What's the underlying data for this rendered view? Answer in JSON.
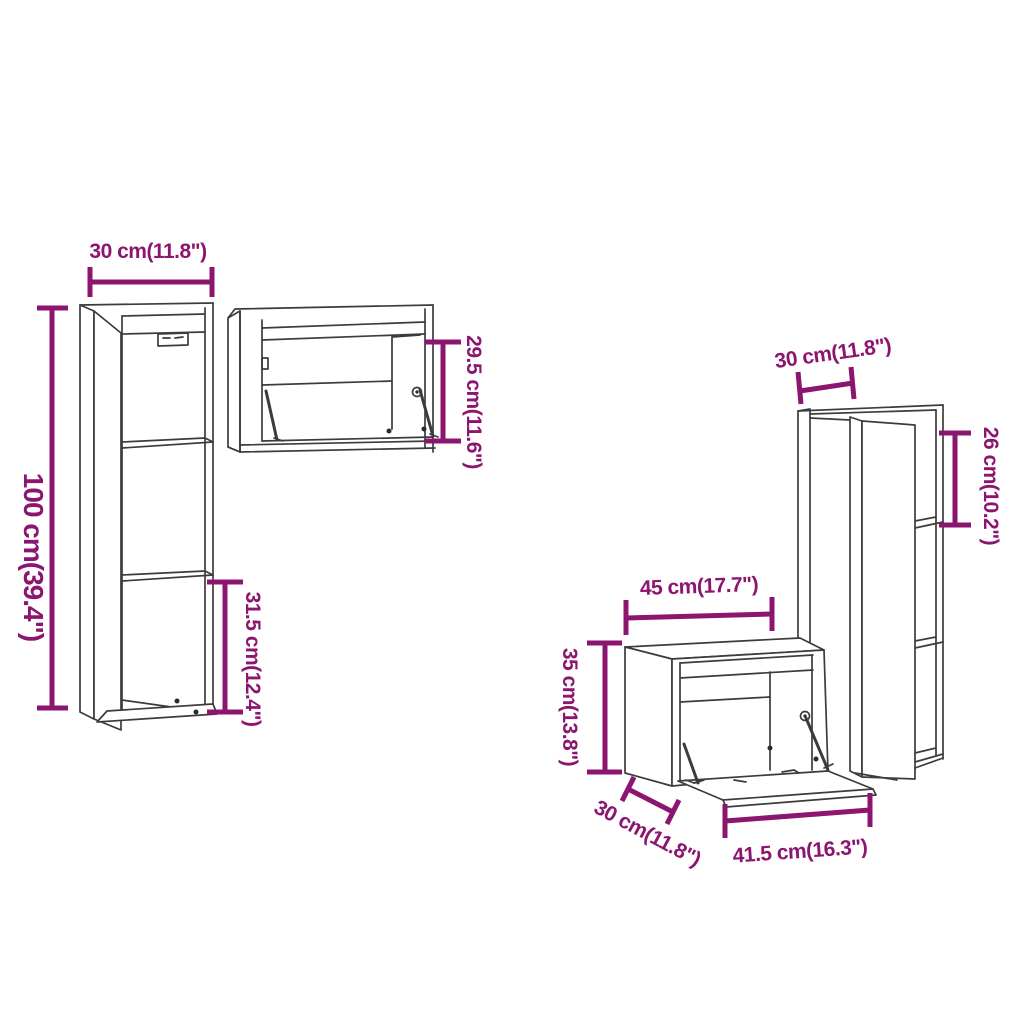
{
  "colors": {
    "annotation": "#8C156F",
    "line_art": "#3C3C3C",
    "background": "#FFFFFF"
  },
  "cabinets": [
    {
      "name": "tall-wall-cabinet-left",
      "dimensions": [
        {
          "id": "width",
          "text": "30 cm(11.8\")"
        },
        {
          "id": "height",
          "text": "100 cm(39.4\")"
        },
        {
          "id": "lower-compartment-height",
          "text": "31.5 cm(12.4\")"
        }
      ]
    },
    {
      "name": "horizontal-flap-wall-cabinet",
      "dimensions": [
        {
          "id": "height",
          "text": "29.5 cm(11.6\")"
        }
      ]
    },
    {
      "name": "tall-wall-cabinet-right",
      "dimensions": [
        {
          "id": "width",
          "text": "30 cm(11.8\")"
        },
        {
          "id": "top-compartment-height",
          "text": "26 cm(10.2\")"
        }
      ]
    },
    {
      "name": "flap-wall-cabinet-bottom",
      "dimensions": [
        {
          "id": "width",
          "text": "45 cm(17.7\")"
        },
        {
          "id": "height",
          "text": "35 cm(13.8\")"
        },
        {
          "id": "depth",
          "text": "30 cm(11.8\")"
        },
        {
          "id": "flap-width",
          "text": "41.5 cm(16.3\")"
        }
      ]
    }
  ]
}
